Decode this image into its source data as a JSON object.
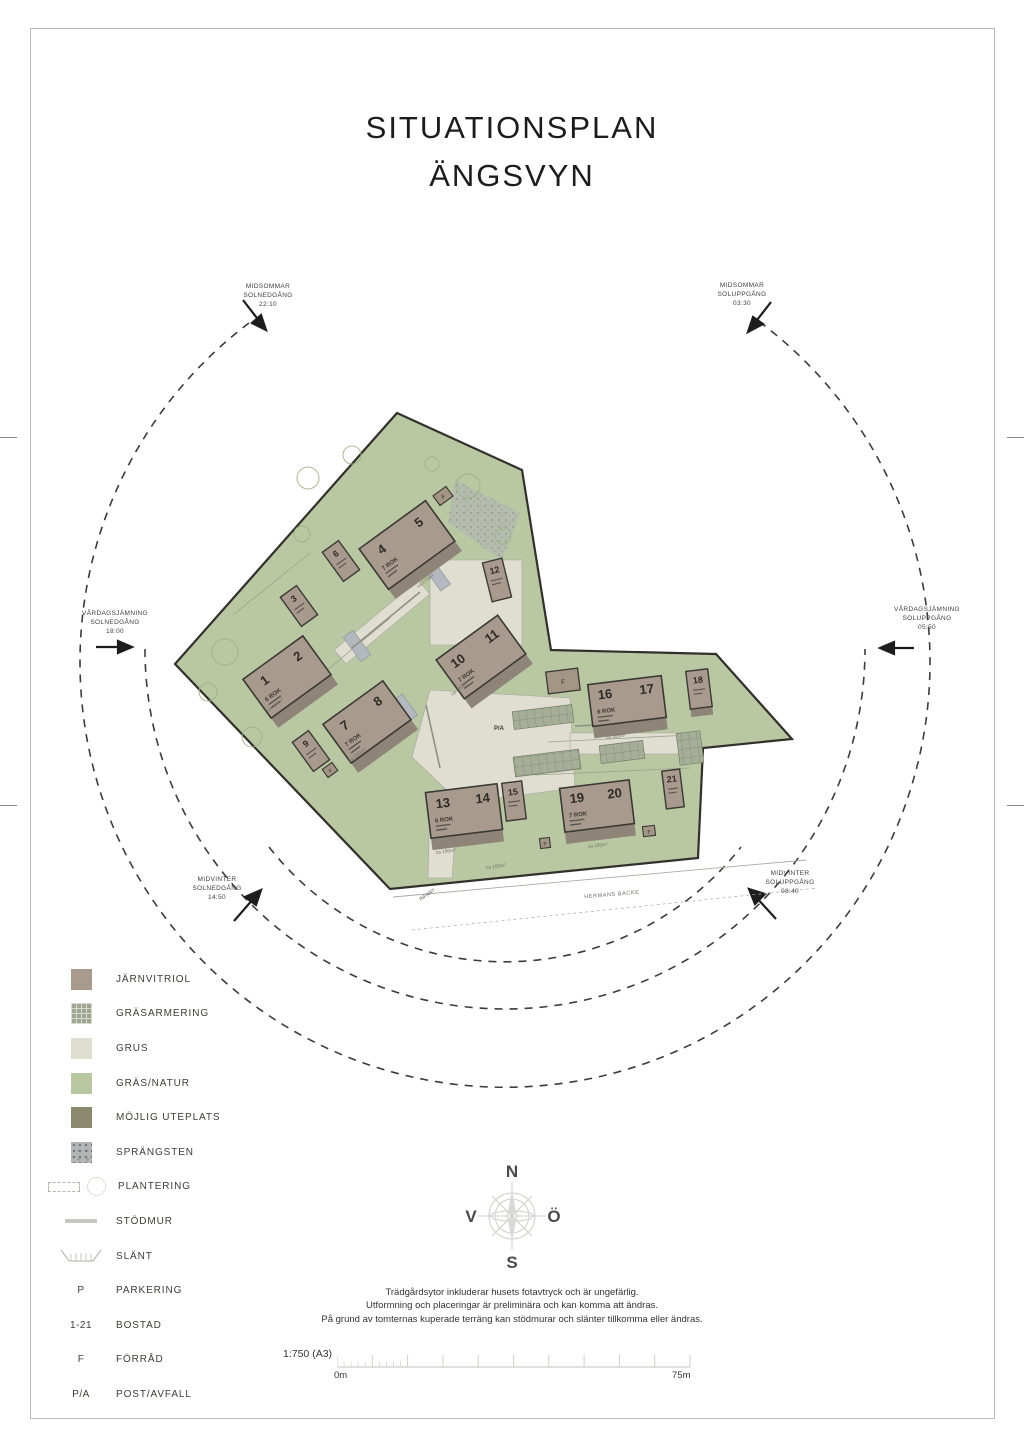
{
  "title": {
    "line1": "SITUATIONSPLAN",
    "line2": "ÄNGSVYN"
  },
  "sun_labels": {
    "midsommar_solnedgang": {
      "l1": "MIDSOMMAR",
      "l2": "SOLNEDGÅNG",
      "l3": "22:10"
    },
    "midsommar_soluppgang": {
      "l1": "MIDSOMMAR",
      "l2": "SOLUPPGÅNG",
      "l3": "03:30"
    },
    "vardagsjamning_solnedgang": {
      "l1": "VÅRDAGSJÄMNING",
      "l2": "SOLNEDGÅNG",
      "l3": "18:00"
    },
    "vardagsjamning_soluppgang": {
      "l1": "VÅRDAGSJÄMNING",
      "l2": "SOLUPPGÅNG",
      "l3": "05:50"
    },
    "midvinter_solnedgang": {
      "l1": "MIDVINTER",
      "l2": "SOLNEDGÅNG",
      "l3": "14:50"
    },
    "midvinter_soluppgang": {
      "l1": "MIDVINTER",
      "l2": "SOLUPPGÅNG",
      "l3": "08:40"
    }
  },
  "plan": {
    "houses": [
      {
        "n1": "1",
        "n2": "2",
        "rok": "6 ROK"
      },
      {
        "n1": "4",
        "n2": "5",
        "rok": "7 ROK"
      },
      {
        "n1": "7",
        "n2": "8",
        "rok": "7 ROK"
      },
      {
        "n1": "10",
        "n2": "11",
        "rok": "7 ROK"
      },
      {
        "n1": "13",
        "n2": "14",
        "rok": "6 ROK"
      },
      {
        "n1": "16",
        "n2": "17",
        "rok": "6 ROK"
      },
      {
        "n1": "19",
        "n2": "20",
        "rok": "7 ROK"
      }
    ],
    "small_houses": [
      "3",
      "6",
      "9",
      "12",
      "15",
      "18",
      "21"
    ],
    "shed_label": "F",
    "post_label": "P/A",
    "street": "HERMANS BACKE",
    "entry": "INFART",
    "area_labels": [
      "ca 155m²",
      "ca 170m²",
      "ca 230m²",
      "ca 140m²",
      "ca 180m²",
      "ca 320m²",
      "ca 205m²",
      "ca 160m²"
    ]
  },
  "legend": {
    "items": [
      {
        "label": "JÄRNVITRIOL"
      },
      {
        "label": "GRÄSARMERING"
      },
      {
        "label": "GRUS"
      },
      {
        "label": "GRÄS/NATUR"
      },
      {
        "label": "MÖJLIG UTEPLATS"
      },
      {
        "label": "SPRÄNGSTEN"
      },
      {
        "label": "PLANTERING"
      },
      {
        "label": "STÖDMUR"
      },
      {
        "label": "SLÄNT"
      },
      {
        "symbol": "P",
        "label": "PARKERING"
      },
      {
        "symbol": "1-21",
        "label": "BOSTAD"
      },
      {
        "symbol": "F",
        "label": "FÖRRÅD"
      },
      {
        "symbol": "P/A",
        "label": "POST/AVFALL"
      }
    ]
  },
  "compass": {
    "n": "N",
    "e": "Ö",
    "s": "S",
    "w": "V"
  },
  "notes": {
    "line1": "Trädgårdsytor inkluderar husets fotavtryck och är ungefärlig.",
    "line2": "Utformning och placeringar är preliminära och kan komma att ändras.",
    "line3": "På grund av tomternas kuperade terräng kan stödmurar och slänter tillkomma eller ändras."
  },
  "scalebar": {
    "ratio": "1:750 (A3)",
    "start": "0m",
    "end": "75m"
  },
  "colors": {
    "jarnvitriol": "#a89a8c",
    "grus": "#e0ded1",
    "gras_natur": "#b9c7a3",
    "mojlig_uteplats": "#8b8a6e",
    "grasarmering": "#9fa591",
    "sprangsten": "#b2b6b4"
  }
}
